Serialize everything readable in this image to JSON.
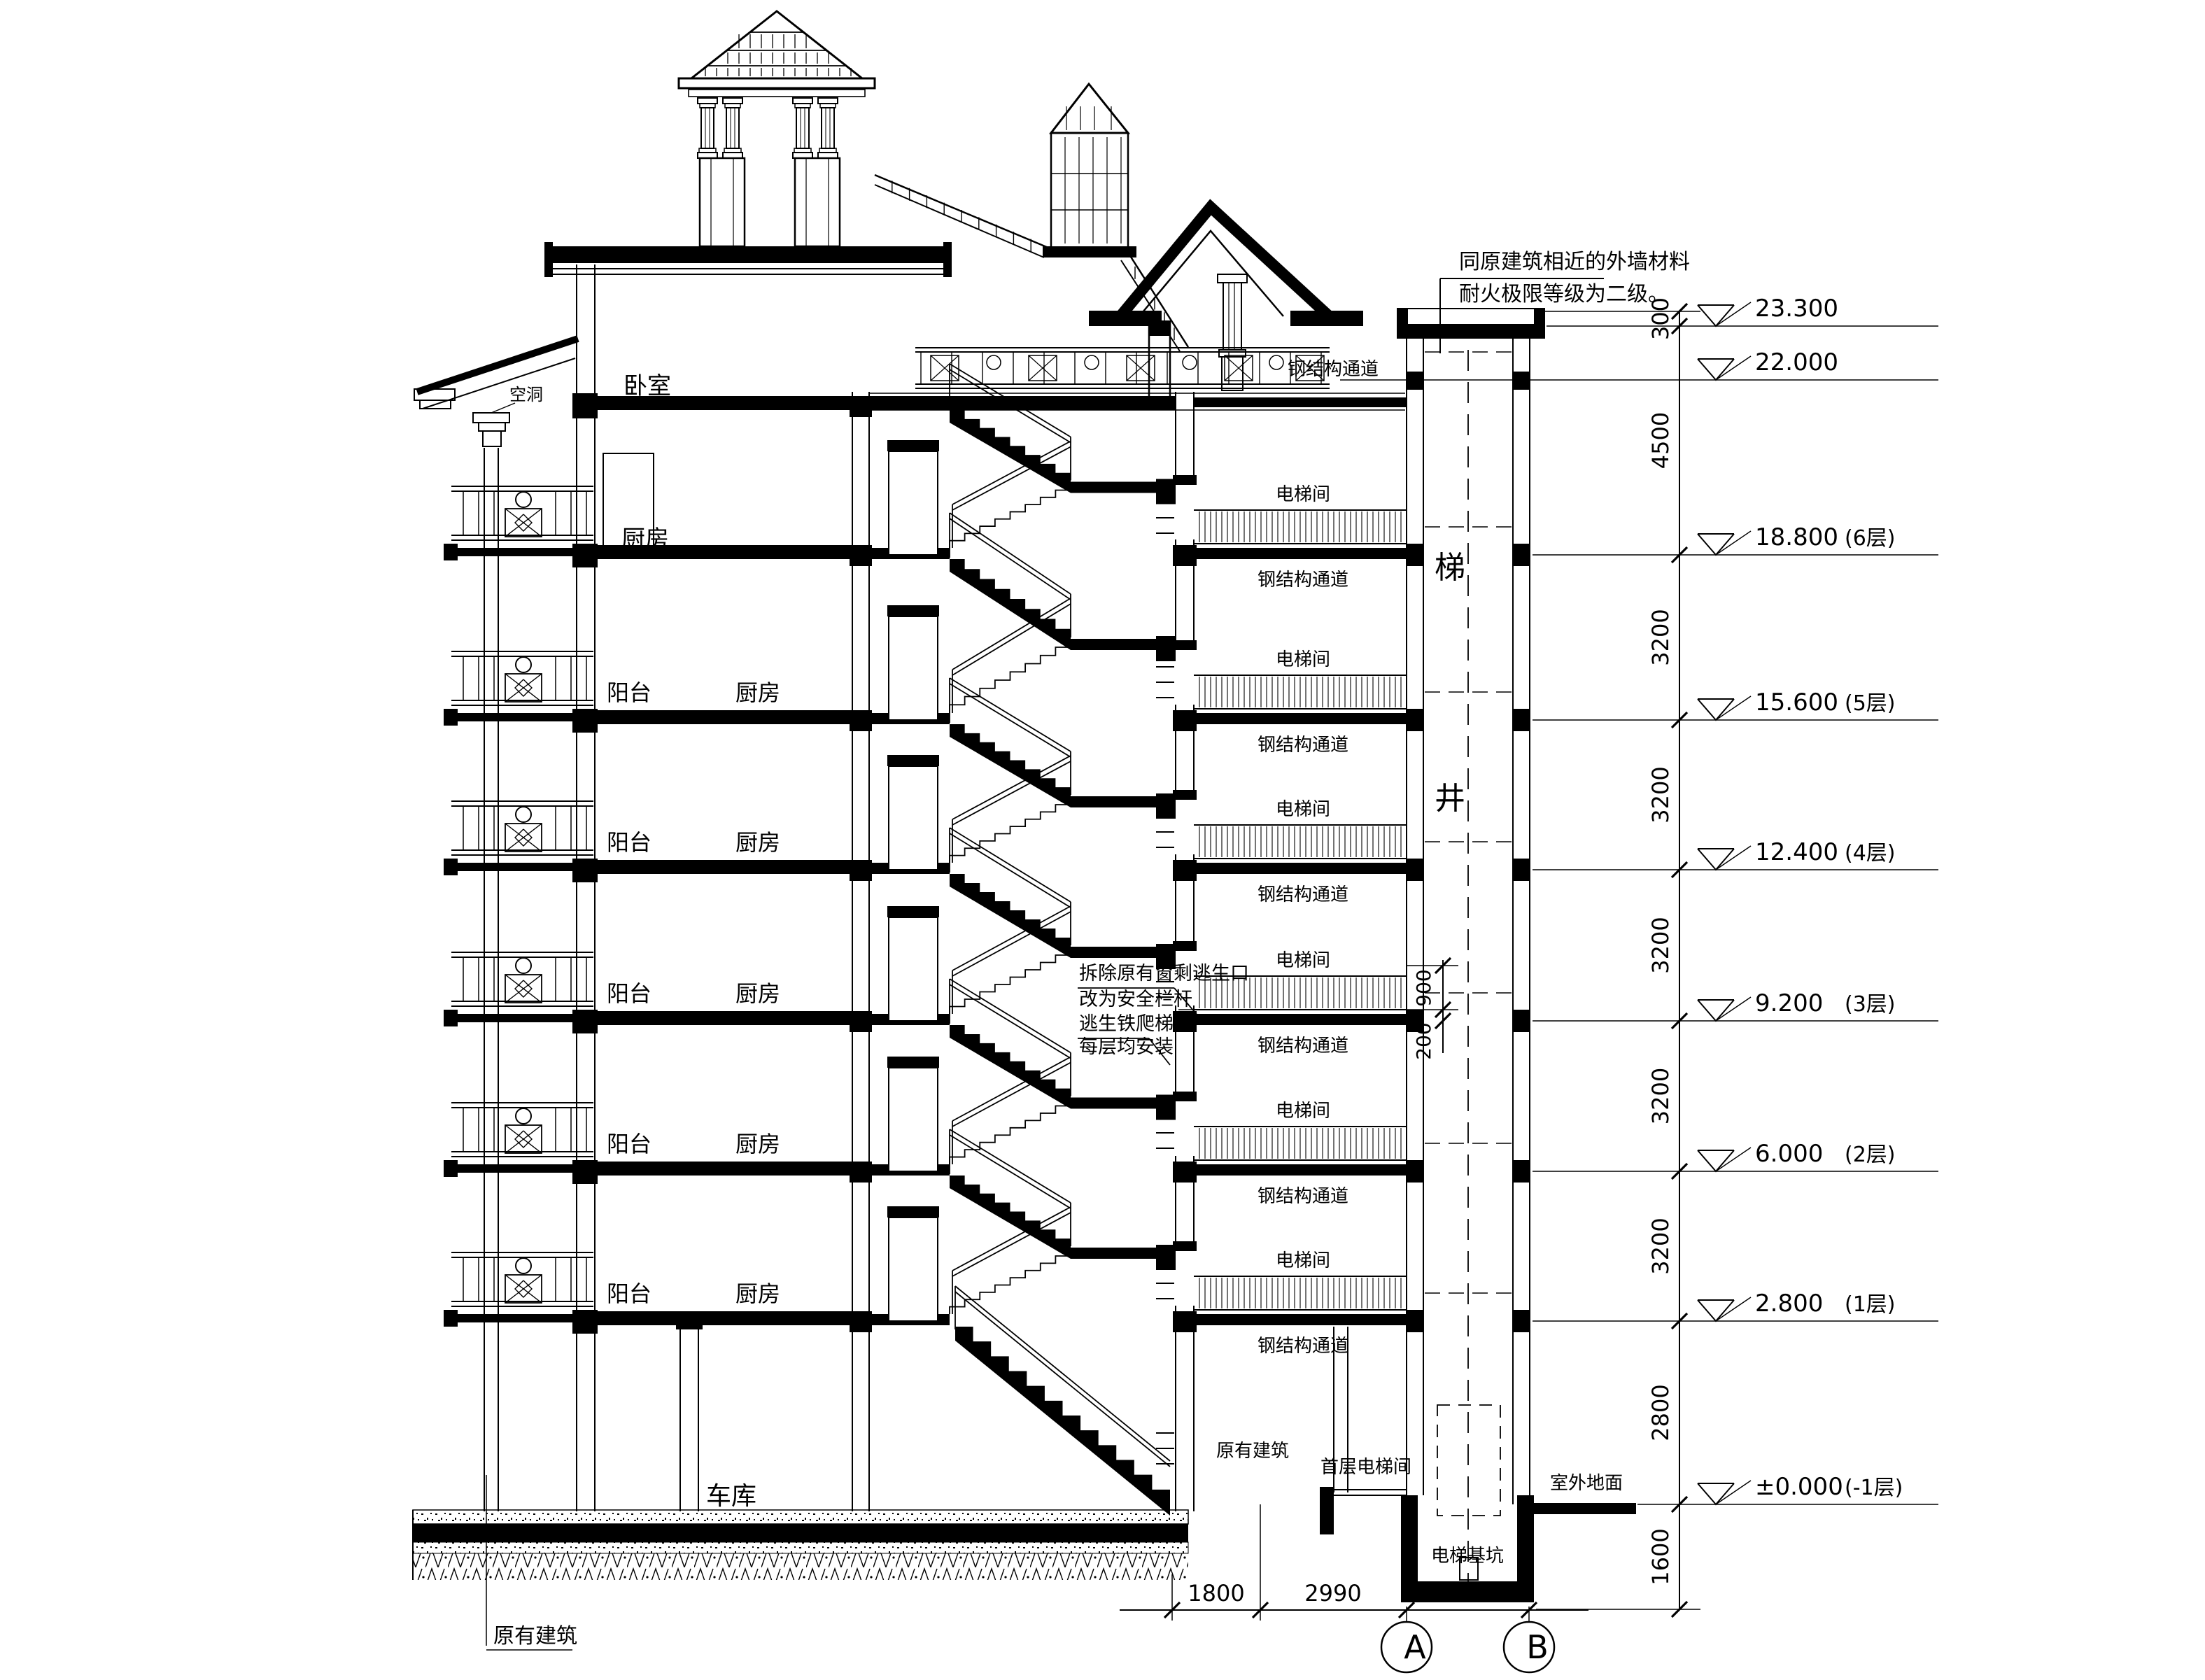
{
  "drawing": {
    "notes": [
      "同原建筑相近的外墙材料",
      "耐火极限等级为二级。"
    ],
    "escape_notes": [
      "拆除原有窗剩逃生口",
      "改为安全栏杆",
      "逃生铁爬梯",
      "每层均安装"
    ],
    "labels": {
      "bedroom": "卧室",
      "kitchen": "厨房",
      "balcony": "阳台",
      "garage": "车库",
      "roof_void": "空洞",
      "steel_corridor": "钢结构通道",
      "elevator_room": "电梯间",
      "first_floor_elevator_room": "首层电梯间",
      "elevator_pit": "电梯基坑",
      "outdoor_ground": "室外地面",
      "existing_building": "原有建筑",
      "shaft_char_stair": "梯",
      "shaft_char_well": "井"
    },
    "elevations": [
      {
        "value": "23.300",
        "floor": ""
      },
      {
        "value": "22.000",
        "floor": ""
      },
      {
        "value": "18.800",
        "floor": "(6层)"
      },
      {
        "value": "15.600",
        "floor": "(5层)"
      },
      {
        "value": "12.400",
        "floor": "(4层)"
      },
      {
        "value": "9.200",
        "floor": "(3层)"
      },
      {
        "value": "6.000",
        "floor": "(2层)"
      },
      {
        "value": "2.800",
        "floor": "(1层)"
      },
      {
        "value": "±0.000",
        "floor": "(-1层)"
      }
    ],
    "dims": {
      "right": [
        "300",
        "4500",
        "3200",
        "3200",
        "3200",
        "3200",
        "3200",
        "2800",
        "1600"
      ],
      "mid": [
        "900",
        "200"
      ],
      "bottom": [
        "1800",
        "2990",
        "2500"
      ]
    },
    "axes": [
      "A",
      "B"
    ]
  }
}
